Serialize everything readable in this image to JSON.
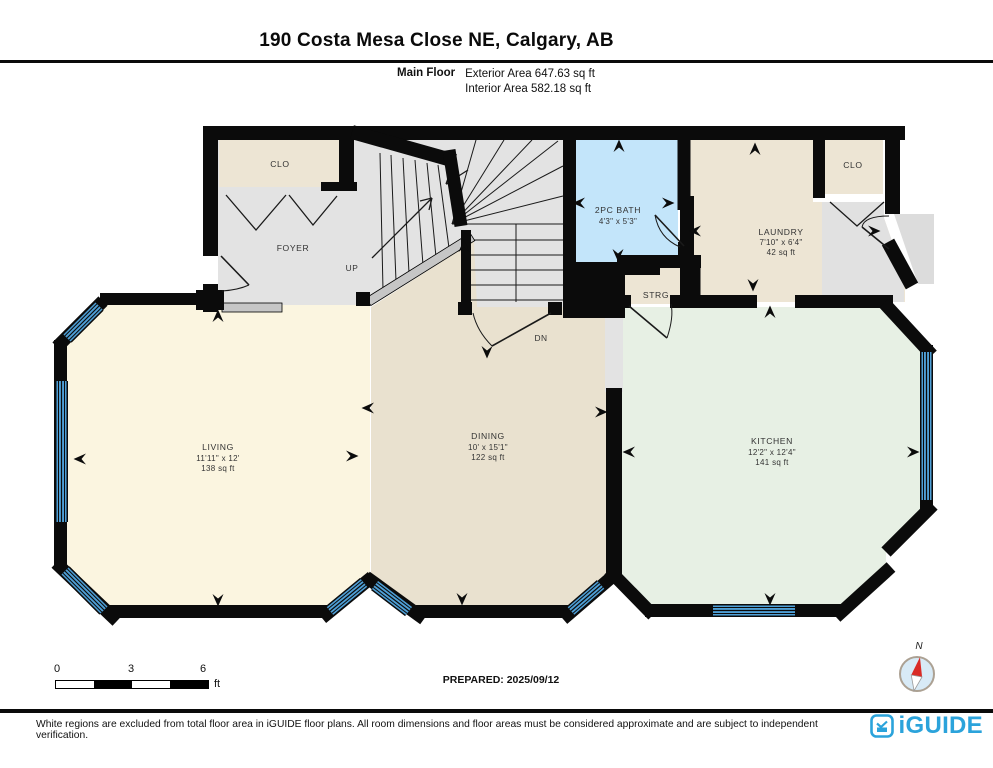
{
  "header": {
    "title": "190 Costa Mesa Close NE, Calgary, AB",
    "floor_label": "Main Floor",
    "exterior_area": "Exterior Area 647.63 sq ft",
    "interior_area": "Interior Area 582.18 sq ft"
  },
  "rooms": {
    "foyer_closet": {
      "name": "CLO"
    },
    "foyer": {
      "name": "FOYER"
    },
    "bath": {
      "name": "2PC BATH",
      "dims": "4'3\" x 5'3\""
    },
    "laundry": {
      "name": "LAUNDRY",
      "dims": "7'10\" x 6'4\"",
      "area": "42 sq ft"
    },
    "laundry_closet": {
      "name": "CLO"
    },
    "storage": {
      "name": "STRG"
    },
    "living": {
      "name": "LIVING",
      "dims": "11'11\" x 12'",
      "area": "138 sq ft"
    },
    "dining": {
      "name": "DINING",
      "dims": "10' x 15'1\"",
      "area": "122 sq ft"
    },
    "kitchen": {
      "name": "KITCHEN",
      "dims": "12'2\" x 12'4\"",
      "area": "141 sq ft"
    }
  },
  "stairs": {
    "up": "UP",
    "down": "DN"
  },
  "scale_bar": {
    "ticks": [
      "0",
      "3",
      "6"
    ],
    "unit": "ft"
  },
  "prepared": "PREPARED: 2025/09/12",
  "compass": {
    "north": "N"
  },
  "footer": {
    "disclaimer": "White regions are excluded from total floor area in iGUIDE floor plans. All room dimensions and floor areas must be considered approximate and are subject to independent verification.",
    "brand": "iGUIDE"
  },
  "colors": {
    "walls": "#0b0b0b",
    "living_fill": "#FBF5E0",
    "dining_fill": "#E9E1CF",
    "kitchen_fill": "#E7F0E4",
    "closet_fill": "#EDE5D4",
    "hall_fill": "#E3E3E3",
    "bath_fill": "#C3E5FA",
    "window_blue": "#4E9FD6",
    "brand_blue": "#2BA3DB"
  }
}
